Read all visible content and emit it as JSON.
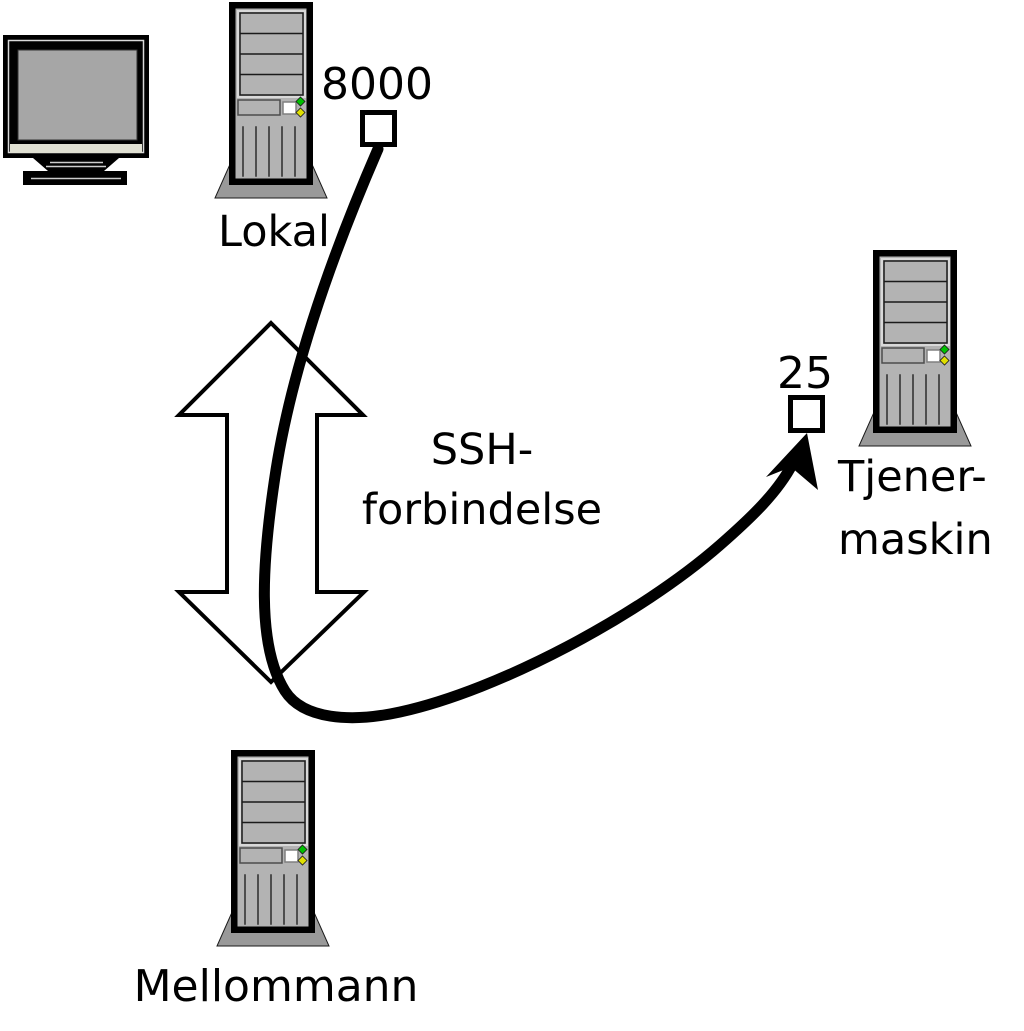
{
  "title": "SSH tunnel port forwarding diagram",
  "colors": {
    "background": "#ffffff",
    "outline": "#000000",
    "cable": "#000000",
    "arrow_fill": "#ffffff",
    "arrow_stroke": "#000000",
    "tower_body": "#b3b3b3",
    "tower_base": "#999999",
    "screen": "#a6a6a6",
    "monitor_strip": "#e0e0d2",
    "led_green": "#00c000",
    "led_yellow": "#e0e000",
    "port_box_fill": "#ffffff"
  },
  "nodes": {
    "local": {
      "label": "Lokal"
    },
    "middleman": {
      "label": "Mellommann"
    },
    "server": {
      "label_line1": "Tjener-",
      "label_line2": "maskin"
    }
  },
  "ports": {
    "local_forward_port": {
      "label": "8000"
    },
    "server_port": {
      "label": "25"
    }
  },
  "connection": {
    "label_line1": "SSH-",
    "label_line2": "forbindelse"
  }
}
